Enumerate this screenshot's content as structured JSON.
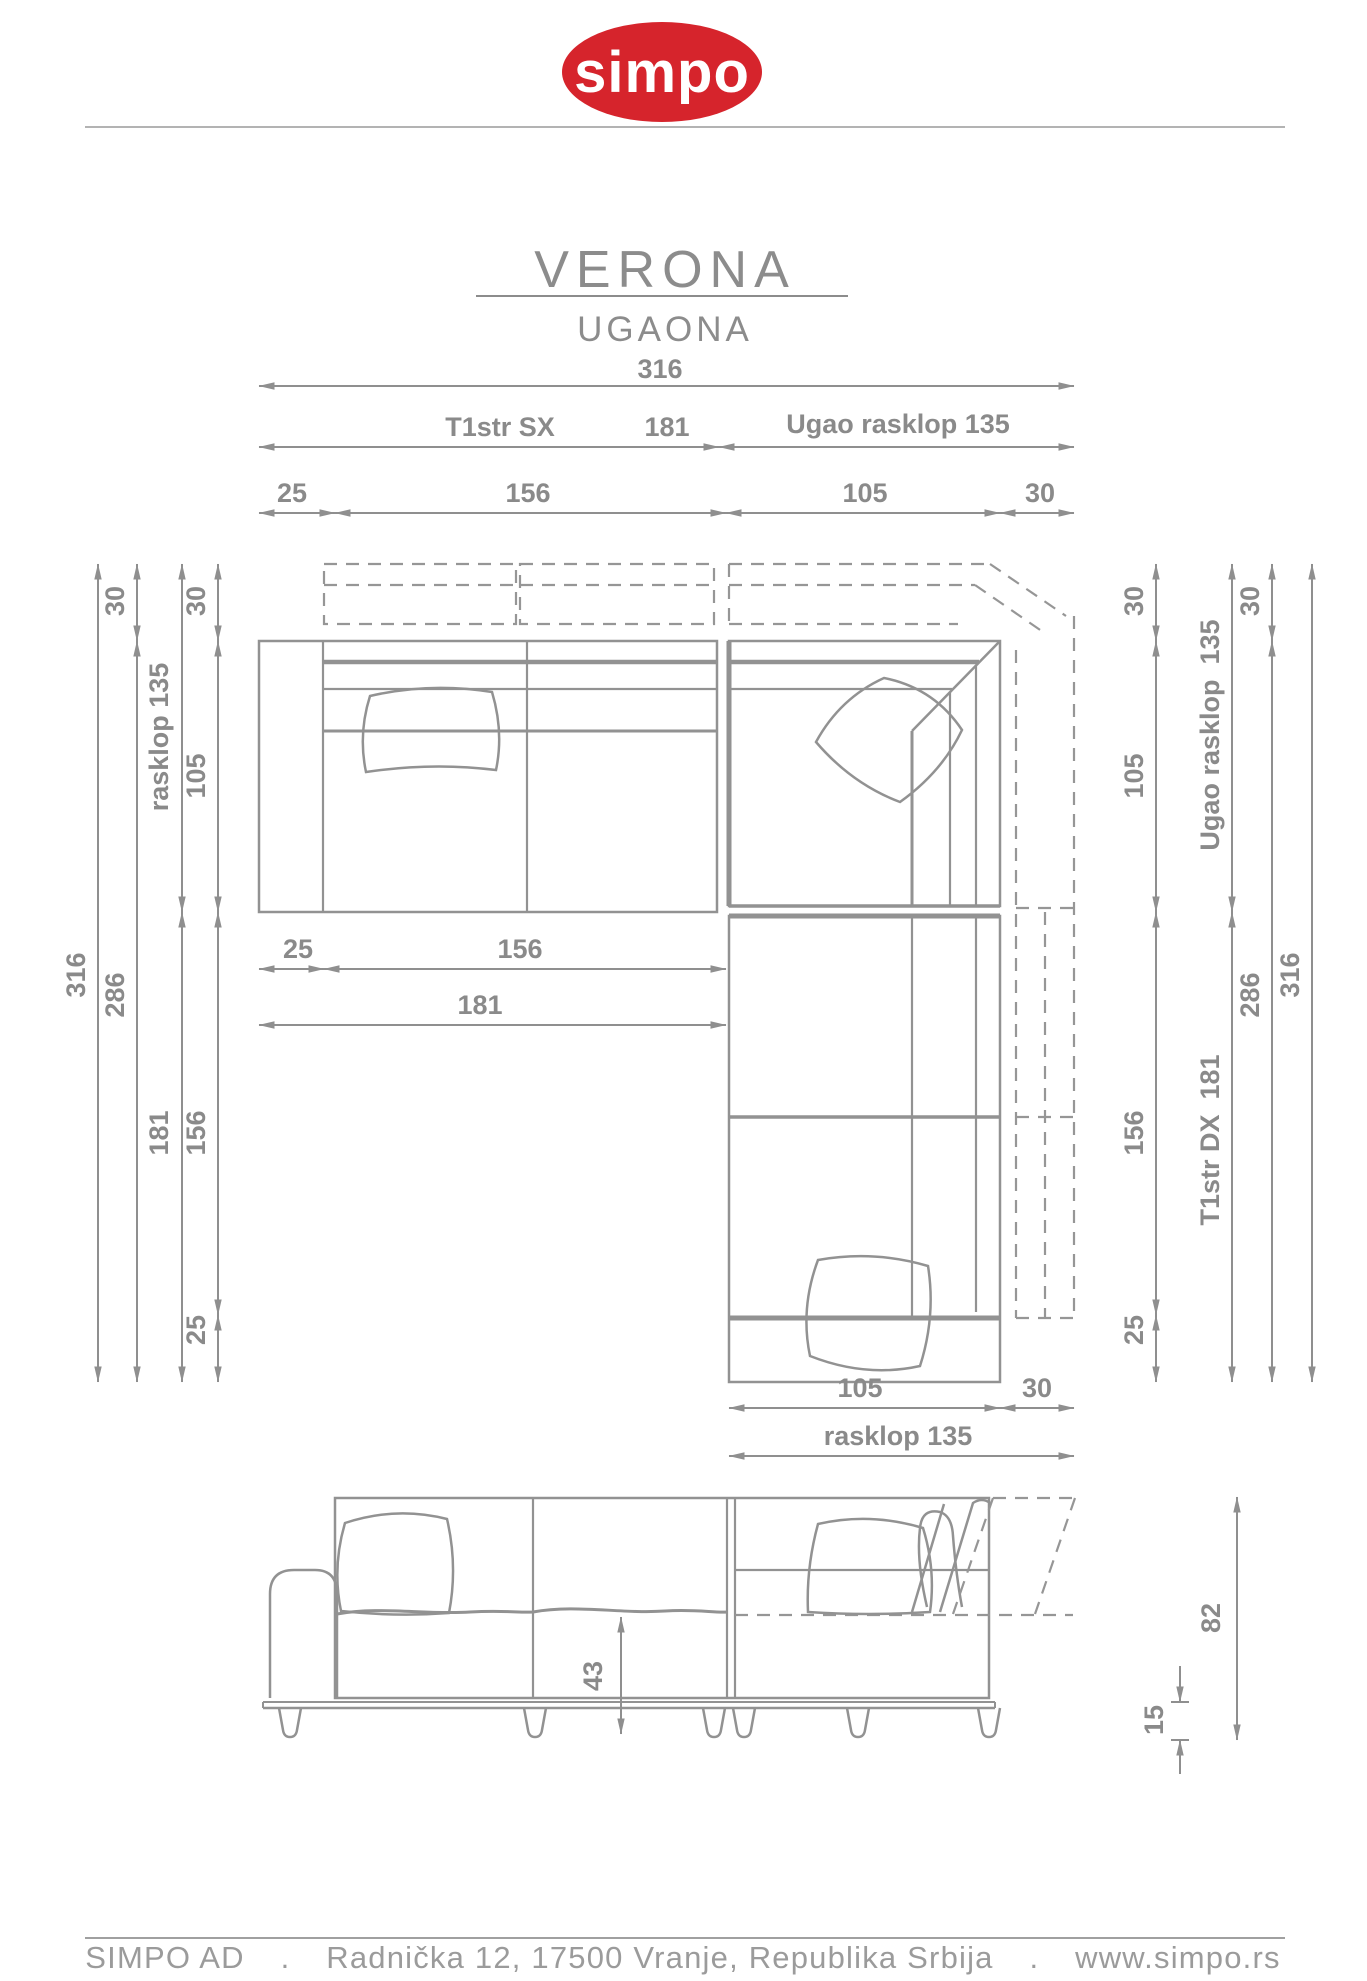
{
  "header": {
    "logo_text": "simpo",
    "brand_color": "#d6242c",
    "title": "VERONA",
    "subtitle": "UGAONA"
  },
  "units": {
    "left_unit_name": "T1str SX",
    "right_unit_name": "T1str DX",
    "corner_name": "Ugao rasklop"
  },
  "dimensions_cm": {
    "total_width": 316,
    "total_depth": 316,
    "body_width": 286,
    "body_depth": 286,
    "side_unit_length": 181,
    "side_unit_seat": 156,
    "arm_width": 25,
    "corner_size": 135,
    "corner_seat": 105,
    "foldout_extension": 30,
    "foldout_depth": 135,
    "total_height": 82,
    "seat_height": 43,
    "base_leg_height": 15
  },
  "labels": {
    "v316": "316",
    "v286": "286",
    "v181": "181",
    "v156": "156",
    "v135": "135",
    "v105": "105",
    "v30": "30",
    "v25": "25",
    "v43": "43",
    "v82": "82",
    "v15": "15",
    "t1str_sx": "T1str SX",
    "t1str_dx_181": "T1str DX  181",
    "ugao_rasklop_135": "Ugao rasklop 135",
    "ugao_rasklop_135_v": "Ugao rasklop  135",
    "rasklop_135": "rasklop 135"
  },
  "footer": {
    "company": "SIMPO AD",
    "dot": ".",
    "address": "Radnička 12, 17500 Vranje, Republika Srbija",
    "website": "www.simpo.rs"
  }
}
